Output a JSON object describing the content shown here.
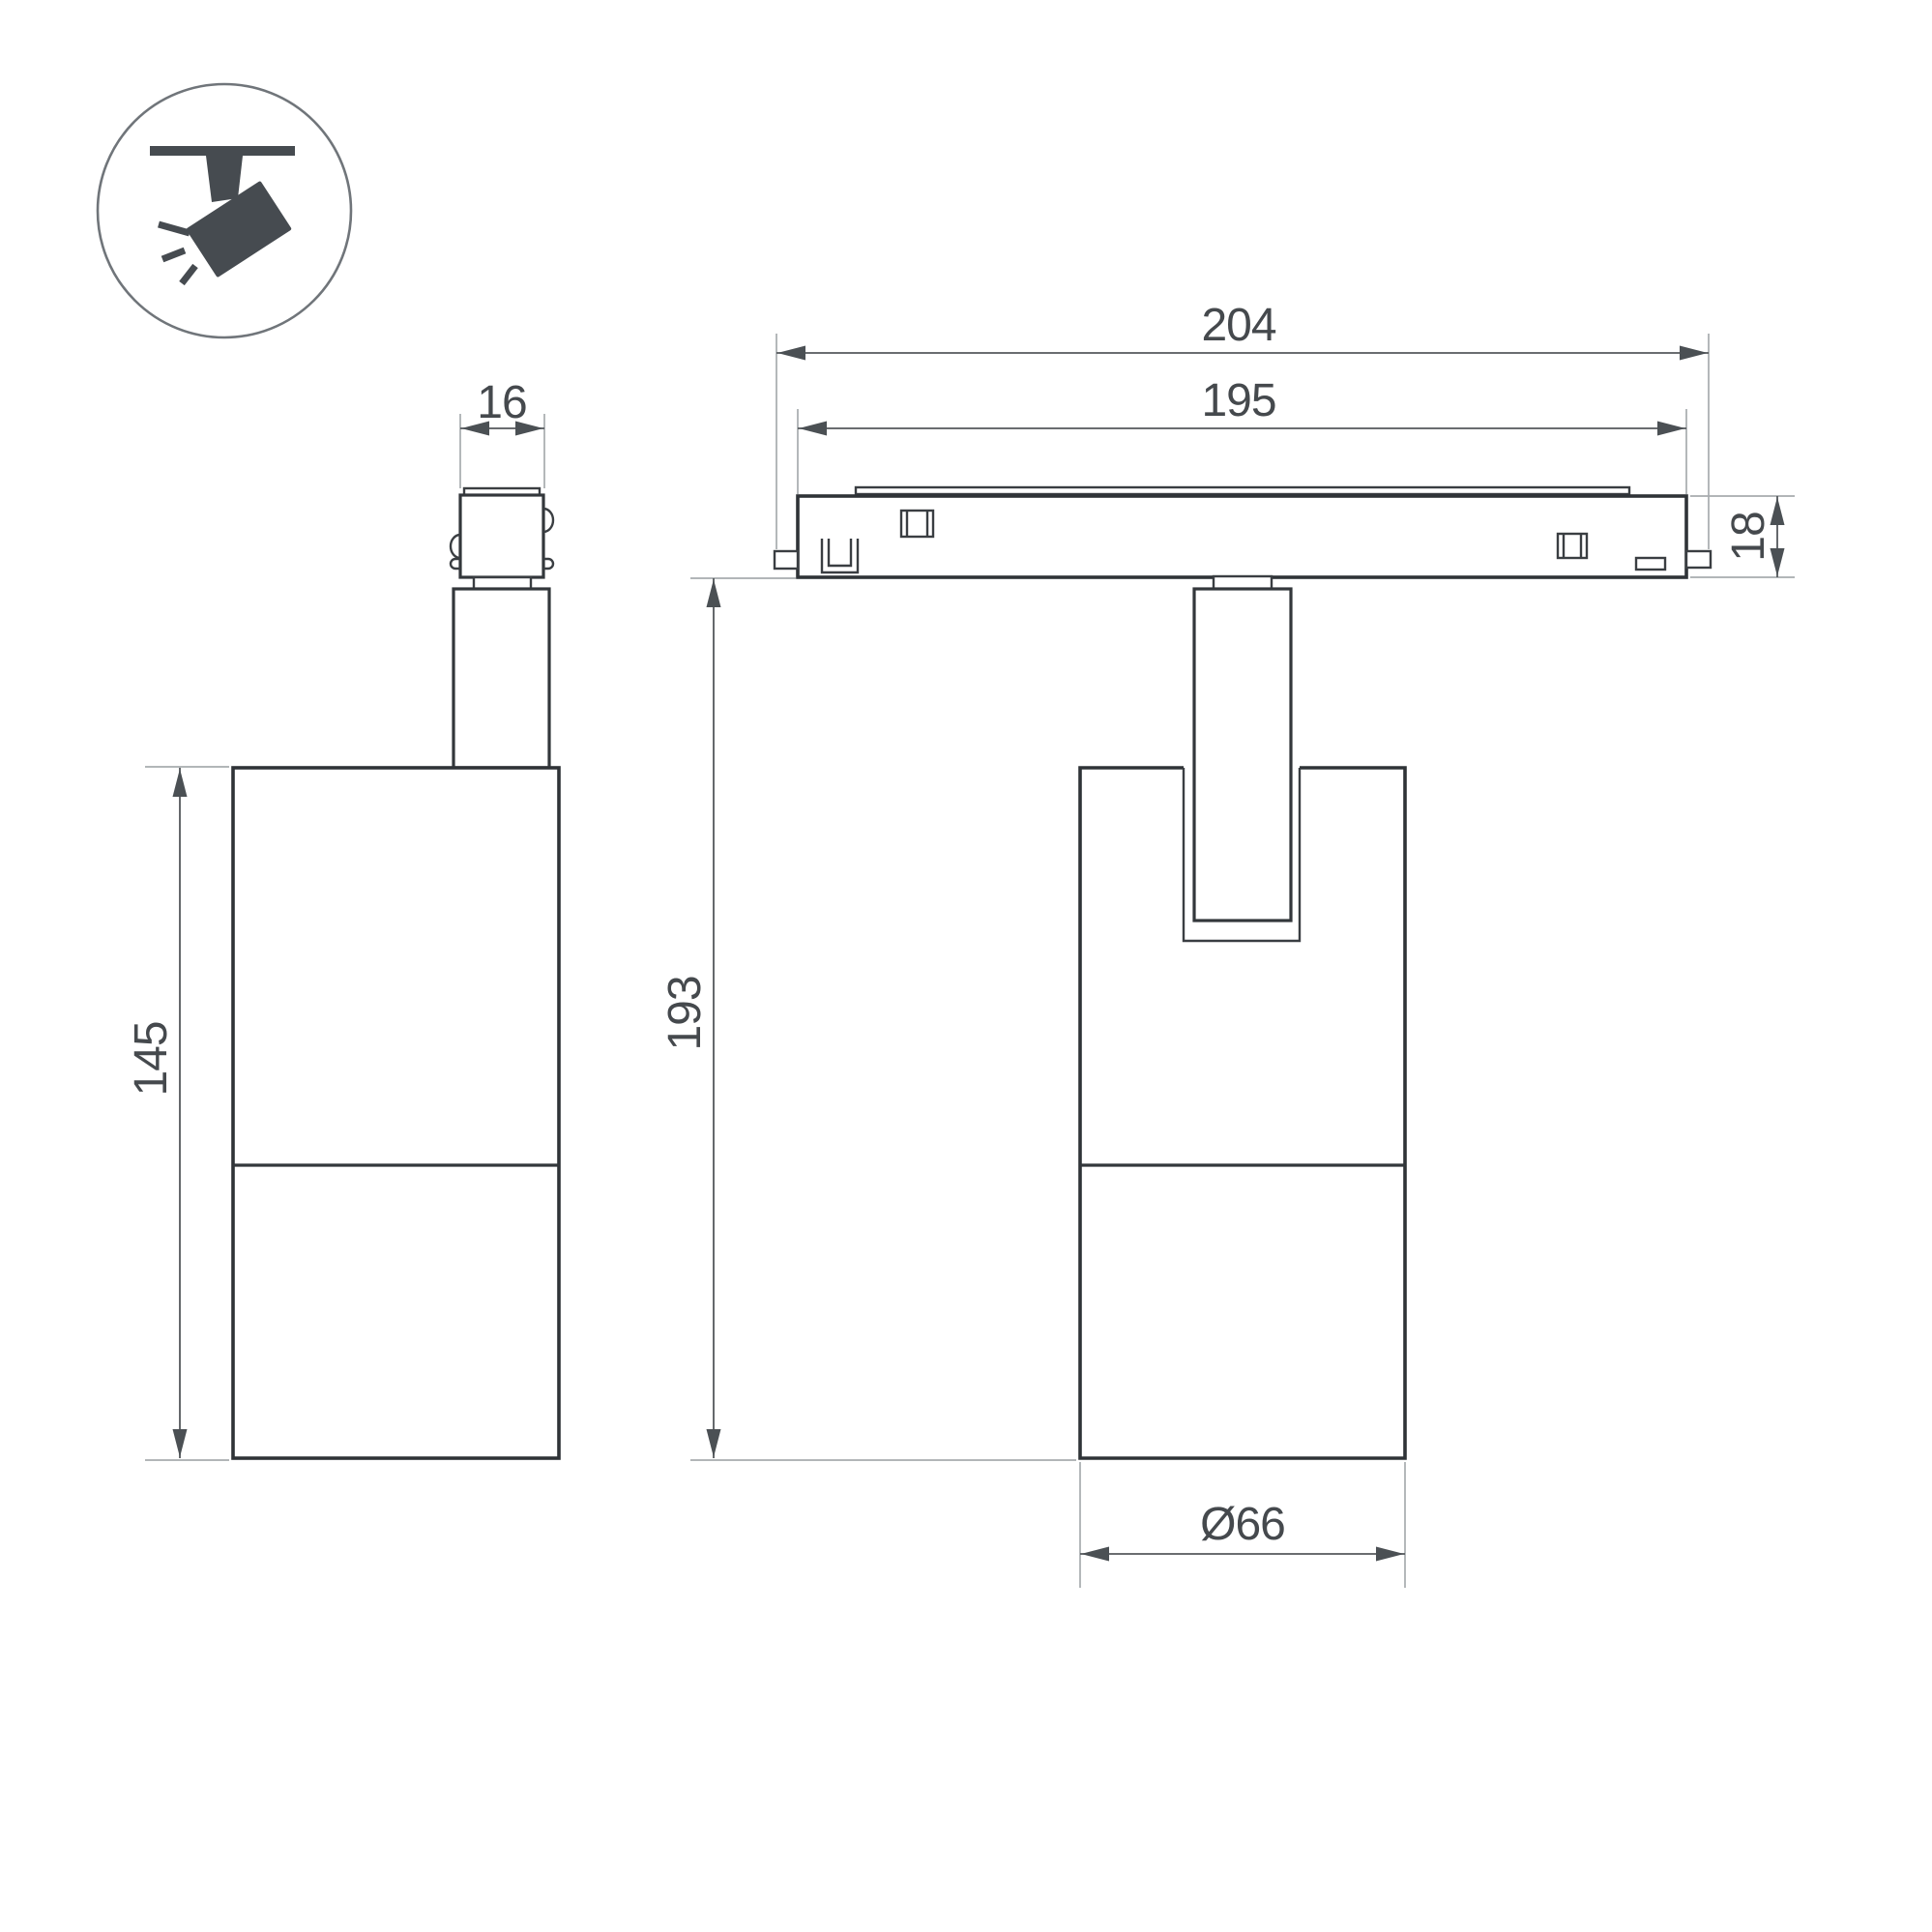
{
  "drawing": {
    "type": "luminaire-dimension-drawing",
    "views": {
      "side_view": "spotlight side view with track adapter",
      "front_view": "spotlight on magnetic track, front view"
    },
    "dims": {
      "d16": {
        "value": "16",
        "meaning": "track adapter width"
      },
      "d145": {
        "value": "145",
        "meaning": "lamp body height"
      },
      "d204": {
        "value": "204",
        "meaning": "track module overall length"
      },
      "d195": {
        "value": "195",
        "meaning": "track module body length"
      },
      "d18": {
        "value": "18",
        "meaning": "track module height"
      },
      "d193": {
        "value": "193",
        "meaning": "overall hanging height below track"
      },
      "d66": {
        "value": "Ø66",
        "meaning": "lamp body diameter"
      }
    },
    "colors": {
      "background": "#ffffff",
      "part_outline": "#33373b",
      "dimension_line": "#54585c",
      "extension_line": "#a7abae",
      "dimension_text": "#45494d",
      "icon_glyph": "#464b50",
      "icon_circle": "#70757a"
    }
  }
}
